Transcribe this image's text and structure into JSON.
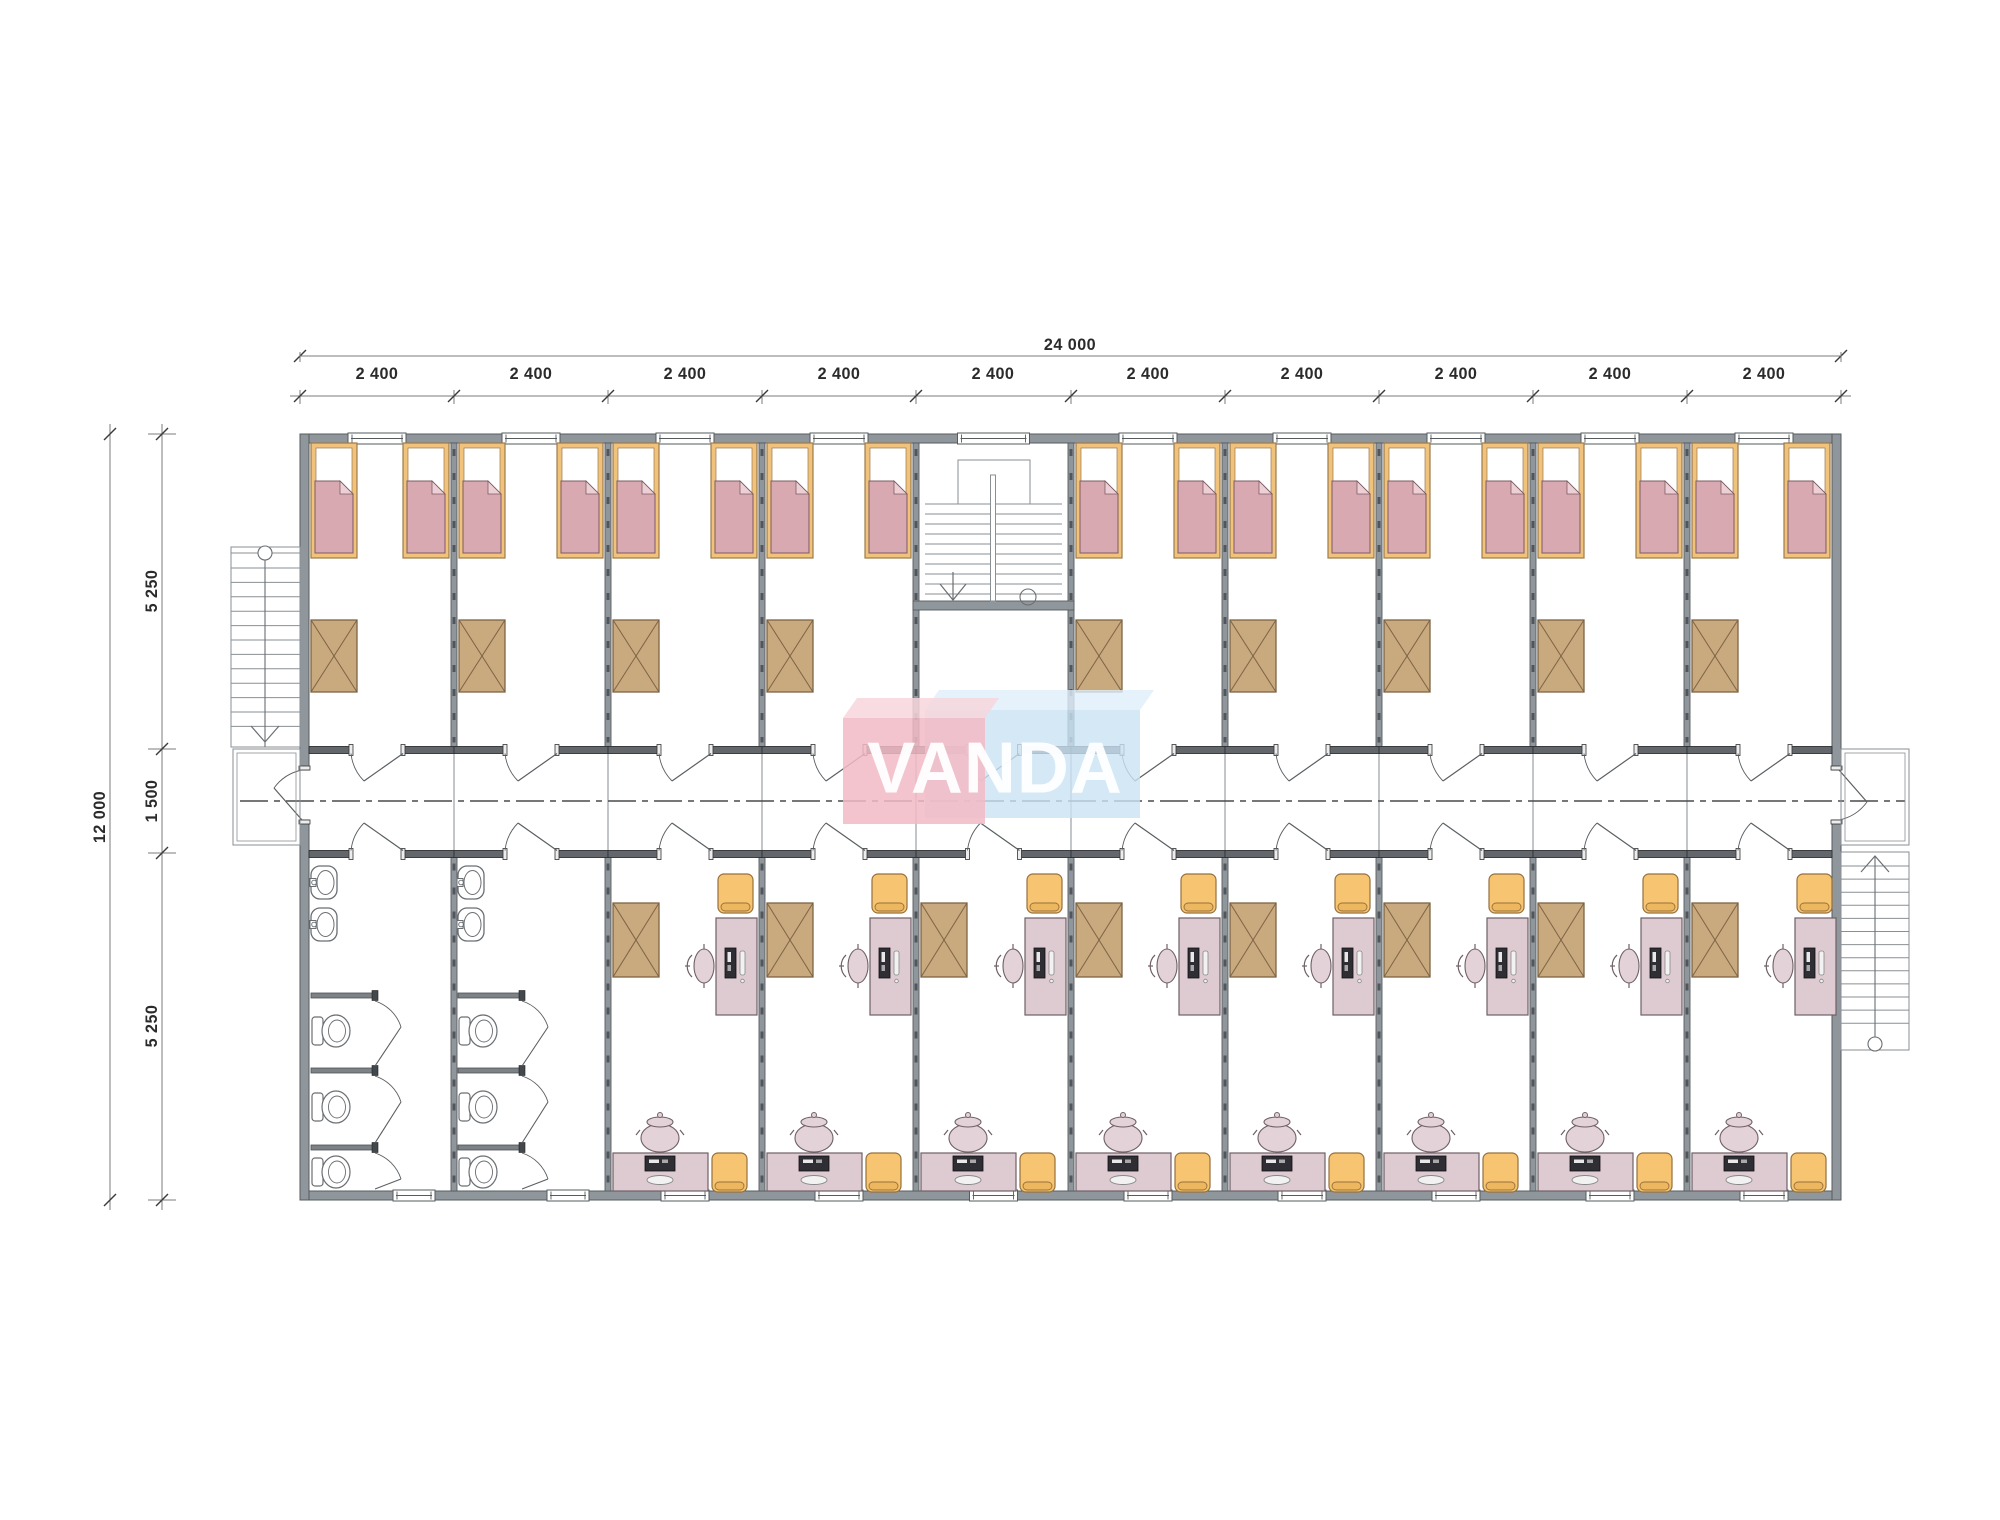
{
  "dimensions": {
    "overall_width_label": "24 000",
    "bay_labels": [
      "2 400",
      "2 400",
      "2 400",
      "2 400",
      "2 400",
      "2 400",
      "2 400",
      "2 400",
      "2 400",
      "2 400"
    ],
    "overall_height_label": "12 000",
    "row_labels": [
      "5 250",
      "1 500",
      "5 250"
    ]
  },
  "logo": {
    "text": "VANDA"
  },
  "plan_contents": {
    "bedrooms": 9,
    "beds_per_bedroom": 2,
    "wardrobes_per_bedroom": 1,
    "office_rooms": 8,
    "bathrooms": 2,
    "sinks_per_bathroom": 2,
    "toilets_per_bathroom": 3,
    "staircases": 3,
    "icons": [
      "bed",
      "wardrobe-cabinet",
      "desk-with-computer",
      "office-chair",
      "stool",
      "toilet",
      "sink",
      "staircase",
      "door-swing",
      "window"
    ]
  },
  "colors": {
    "wall": "#90979c",
    "wallEdge": "#565b5e",
    "wallDash": "#50565c",
    "stub": "#63676b",
    "stubEdge": "#2e3134",
    "cap": "#ededed",
    "bedFrame": "#f0c27c",
    "bedFrameEdge": "#9c7b4b",
    "blanket": "#d9a9b2",
    "blanketEdge": "#7d5c63",
    "fold": "#ecd0d6",
    "cabinet": "#c9a97e",
    "cabinetEdge": "#7d6445",
    "desk": "#decbd2",
    "deskEdge": "#6f6066",
    "chair": "#e3d2d8",
    "monitor": "#2e2e34",
    "stool": "#f7c571",
    "stoolEdge": "#97703c",
    "stoolBand": "#edb75f",
    "fixtureEdge": "#6a6f73",
    "stairLine": "#8a8f93",
    "dimLine": "#7b7b7b",
    "dimText": "#2b2b2b",
    "centerLine": "#4a4a4a",
    "doorLine": "#5a5f63",
    "logoPink": "#f2bac5",
    "logoPinkTop": "#f7d6dc",
    "logoBlue": "#c9e2f4",
    "logoBlueTop": "#dfeefa",
    "logoText": "#ffffff"
  }
}
